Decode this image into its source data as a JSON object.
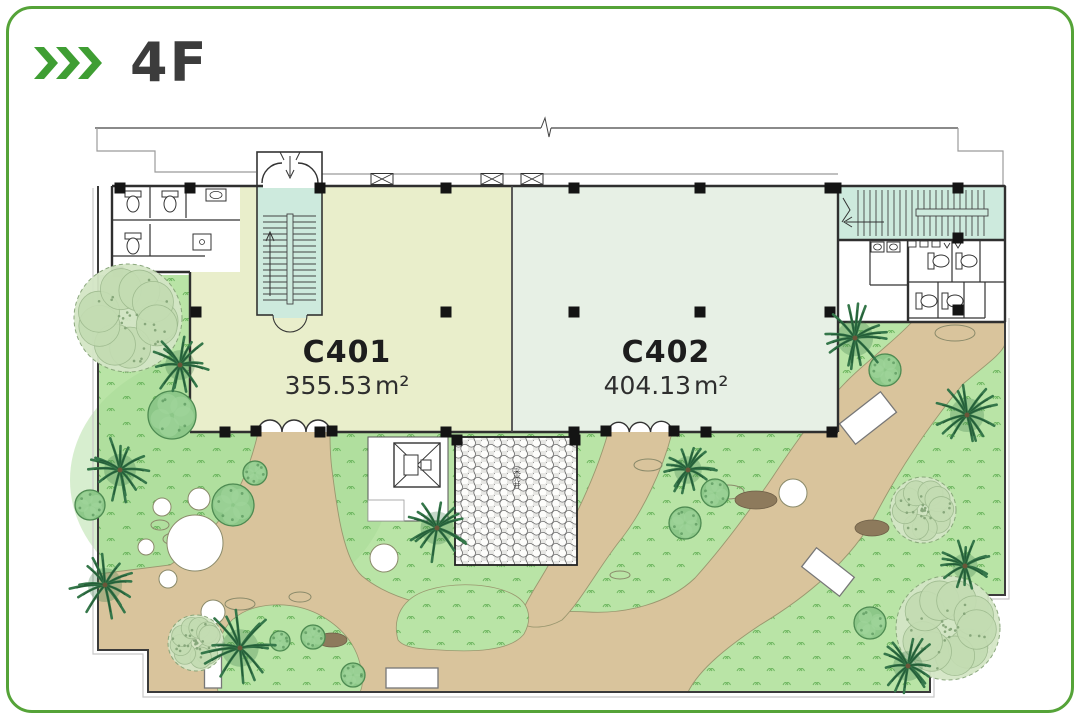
{
  "header": {
    "floor_label": "4F"
  },
  "units": [
    {
      "id": "C401",
      "area_value": "355.53",
      "area_unit": "m²",
      "fill": "#e9eecb"
    },
    {
      "id": "C402",
      "area_value": "404.13",
      "area_unit": "m²",
      "fill": "#e7f0e5"
    }
  ],
  "court": {
    "label": "采光井"
  },
  "colors": {
    "frame_green": "#55a338",
    "chevron_green": "#3f9e33",
    "title": "#3c3c3c",
    "grass": "#b9e4a6",
    "grass_tick": "#5fae52",
    "path_tan": "#d9c49c",
    "stair_mint": "#cdeadd",
    "wall": "#2f2f2f",
    "column": "#141414",
    "tree_dark": "#245c37",
    "tree_mid": "#35774a",
    "bush_fill": "#8cc788",
    "bush_stroke": "#4d8a51",
    "pale_tree": "#d4e6c6",
    "rock": "#8d7a5c"
  },
  "plan": {
    "palms": [
      [
        180,
        365,
        27
      ],
      [
        120,
        470,
        29
      ],
      [
        105,
        585,
        31
      ],
      [
        437,
        528,
        30
      ],
      [
        688,
        470,
        25
      ],
      [
        855,
        338,
        33
      ],
      [
        967,
        415,
        31
      ],
      [
        908,
        666,
        27
      ],
      [
        965,
        566,
        23
      ],
      [
        240,
        648,
        34
      ]
    ],
    "bushes": [
      [
        172,
        415,
        24
      ],
      [
        90,
        505,
        15
      ],
      [
        255,
        473,
        12
      ],
      [
        233,
        505,
        21
      ],
      [
        313,
        637,
        12
      ],
      [
        353,
        675,
        12
      ],
      [
        280,
        641,
        10
      ],
      [
        685,
        523,
        16
      ],
      [
        715,
        493,
        14
      ],
      [
        885,
        370,
        16
      ],
      [
        870,
        623,
        16
      ]
    ],
    "fluffies": [
      [
        128,
        318,
        54
      ],
      [
        948,
        628,
        52
      ],
      [
        923,
        510,
        33
      ],
      [
        196,
        643,
        28
      ]
    ],
    "white_circles": [
      [
        195,
        543,
        28
      ],
      [
        162,
        507,
        9
      ],
      [
        199,
        499,
        11
      ],
      [
        146,
        547,
        8
      ],
      [
        168,
        579,
        9
      ],
      [
        213,
        612,
        12
      ],
      [
        384,
        558,
        14
      ],
      [
        793,
        493,
        14
      ]
    ],
    "benches": [
      [
        868,
        418,
        52,
        26,
        -38
      ],
      [
        828,
        572,
        48,
        24,
        38
      ],
      [
        412,
        678,
        52,
        20,
        0
      ],
      [
        213,
        664,
        17,
        48,
        0
      ]
    ],
    "rocks": [
      [
        756,
        500,
        21,
        9
      ],
      [
        872,
        528,
        17,
        8
      ],
      [
        332,
        640,
        15,
        7
      ]
    ],
    "stones": [
      [
        648,
        465,
        14,
        6
      ],
      [
        728,
        492,
        16,
        7
      ],
      [
        955,
        333,
        20,
        8
      ],
      [
        240,
        604,
        15,
        6
      ],
      [
        160,
        525,
        9,
        5
      ],
      [
        174,
        539,
        11,
        6
      ],
      [
        300,
        597,
        11,
        5
      ],
      [
        620,
        575,
        10,
        4
      ]
    ],
    "columns_top": [
      120,
      190,
      320,
      446,
      574,
      700,
      830
    ],
    "columns_mid": [
      196,
      446,
      574,
      700,
      830
    ],
    "columns_bottom": [
      225,
      320,
      446,
      574,
      706,
      832
    ],
    "columns_extra": [
      [
        836,
        188
      ],
      [
        958,
        188
      ],
      [
        958,
        238
      ],
      [
        958,
        310
      ],
      [
        118,
        272
      ],
      [
        457,
        440
      ],
      [
        575,
        440
      ],
      [
        256,
        431
      ],
      [
        332,
        431
      ],
      [
        606,
        431
      ],
      [
        674,
        431
      ]
    ],
    "windows": [
      [
        382,
        179
      ],
      [
        492,
        179
      ],
      [
        532,
        179
      ]
    ]
  }
}
